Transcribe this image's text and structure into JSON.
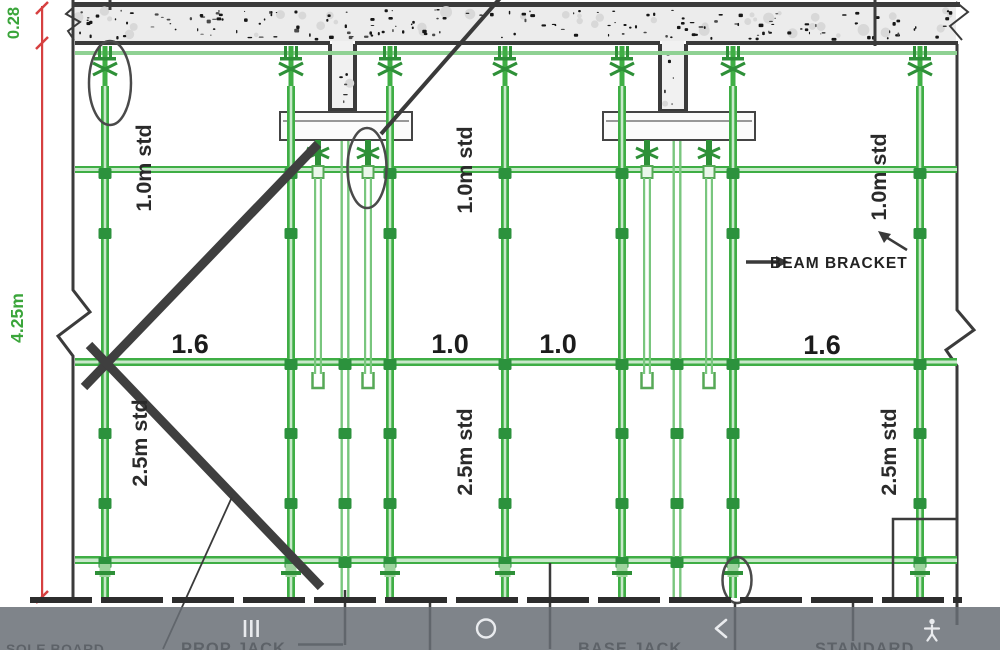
{
  "drawing": {
    "title": "Scaffolding shoring elevation",
    "colors": {
      "green": "#3fae45",
      "green_dark": "#2e9038",
      "green_coupler": "#2c923d",
      "green_tube": "#79c67e",
      "green_pale": "#c9e9cb",
      "green_ledger_light": "#8fd193",
      "dim_red": "#d64040",
      "dim_green": "#3aa53a",
      "line_dark": "#3b3b3b",
      "slab_fill": "#ececec"
    },
    "dimensions": {
      "slab_thickness": "0.28",
      "total_height": "4.25m",
      "bay_widths": [
        "1.6",
        "1.0",
        "1.0",
        "1.6"
      ],
      "upper_std": "1.0m std",
      "lower_std": "2.5m std"
    },
    "annotations": {
      "beam_bracket": "BEAM BRACKET",
      "prop_jack": "PROP JACK",
      "base_jack": "BASE JACK",
      "standard": "STANDARD",
      "sole_board": "SOLE BOARD"
    },
    "scaffold": {
      "standards_x": [
        105,
        291,
        390,
        505,
        622,
        733,
        920
      ],
      "prop_tubes_x": [
        345,
        677
      ],
      "drop_props_x": [
        318,
        368,
        647,
        709
      ],
      "coupler_y": [
        168,
        228,
        359,
        428,
        498,
        557
      ],
      "tube_coupler_y": [
        359,
        428,
        498,
        557
      ]
    }
  },
  "navbar": {
    "recents_icon": "recents",
    "home_icon": "home",
    "back_icon": "back",
    "accessibility_icon": "accessibility"
  }
}
